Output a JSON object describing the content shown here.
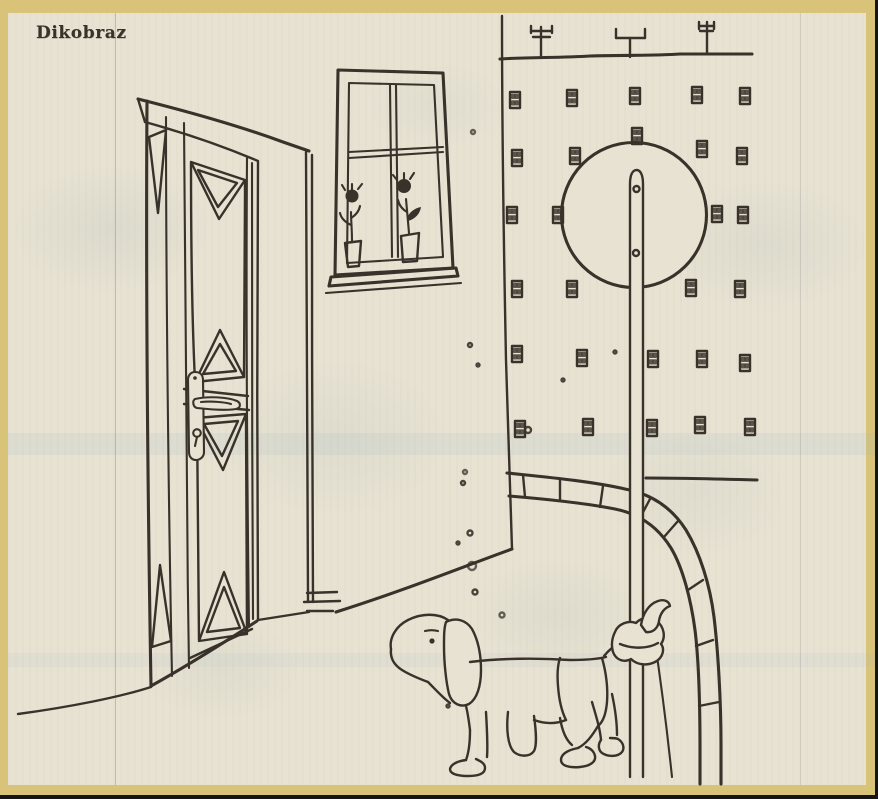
{
  "caption": {
    "text": "Dikobraz"
  },
  "colors": {
    "border": "#d8c379",
    "paper": "#e7e2d2",
    "ink": "#38322b",
    "window": "#2b2622",
    "window_dot": "#d8d3c2",
    "stain_red": "#bf5a3c",
    "edge_black": "#151513"
  },
  "facade": {
    "window_size": {
      "w": 10,
      "h": 16
    },
    "windows": [
      [
        510,
        92
      ],
      [
        567,
        90
      ],
      [
        630,
        88
      ],
      [
        692,
        87
      ],
      [
        740,
        88
      ],
      [
        512,
        150
      ],
      [
        570,
        148
      ],
      [
        632,
        128
      ],
      [
        697,
        141
      ],
      [
        737,
        148
      ],
      [
        507,
        207
      ],
      [
        553,
        207
      ],
      [
        712,
        206
      ],
      [
        738,
        207
      ],
      [
        512,
        281
      ],
      [
        567,
        281
      ],
      [
        686,
        280
      ],
      [
        735,
        281
      ],
      [
        512,
        346
      ],
      [
        577,
        350
      ],
      [
        648,
        351
      ],
      [
        697,
        351
      ],
      [
        740,
        355
      ],
      [
        515,
        421
      ],
      [
        583,
        419
      ],
      [
        647,
        420
      ],
      [
        695,
        417
      ],
      [
        745,
        419
      ]
    ]
  },
  "sign": {
    "bolts": [
      {
        "x": 636.5,
        "y": 189,
        "filled": false
      },
      {
        "x": 636,
        "y": 253,
        "filled": true
      }
    ]
  },
  "specks": {
    "dark": [
      [
        470,
        345,
        2
      ],
      [
        478,
        365,
        1.5
      ],
      [
        463,
        483,
        2
      ],
      [
        470,
        533,
        2.5
      ],
      [
        458,
        543,
        1.5
      ],
      [
        475,
        592,
        2.5
      ],
      [
        528,
        430,
        3
      ],
      [
        563,
        380,
        1.5
      ],
      [
        615,
        352,
        1.5
      ],
      [
        448,
        706,
        1.5
      ]
    ],
    "red": [
      [
        473,
        132,
        2
      ],
      [
        465,
        472,
        2
      ],
      [
        472,
        566,
        4
      ],
      [
        502,
        615,
        2.5
      ]
    ]
  }
}
